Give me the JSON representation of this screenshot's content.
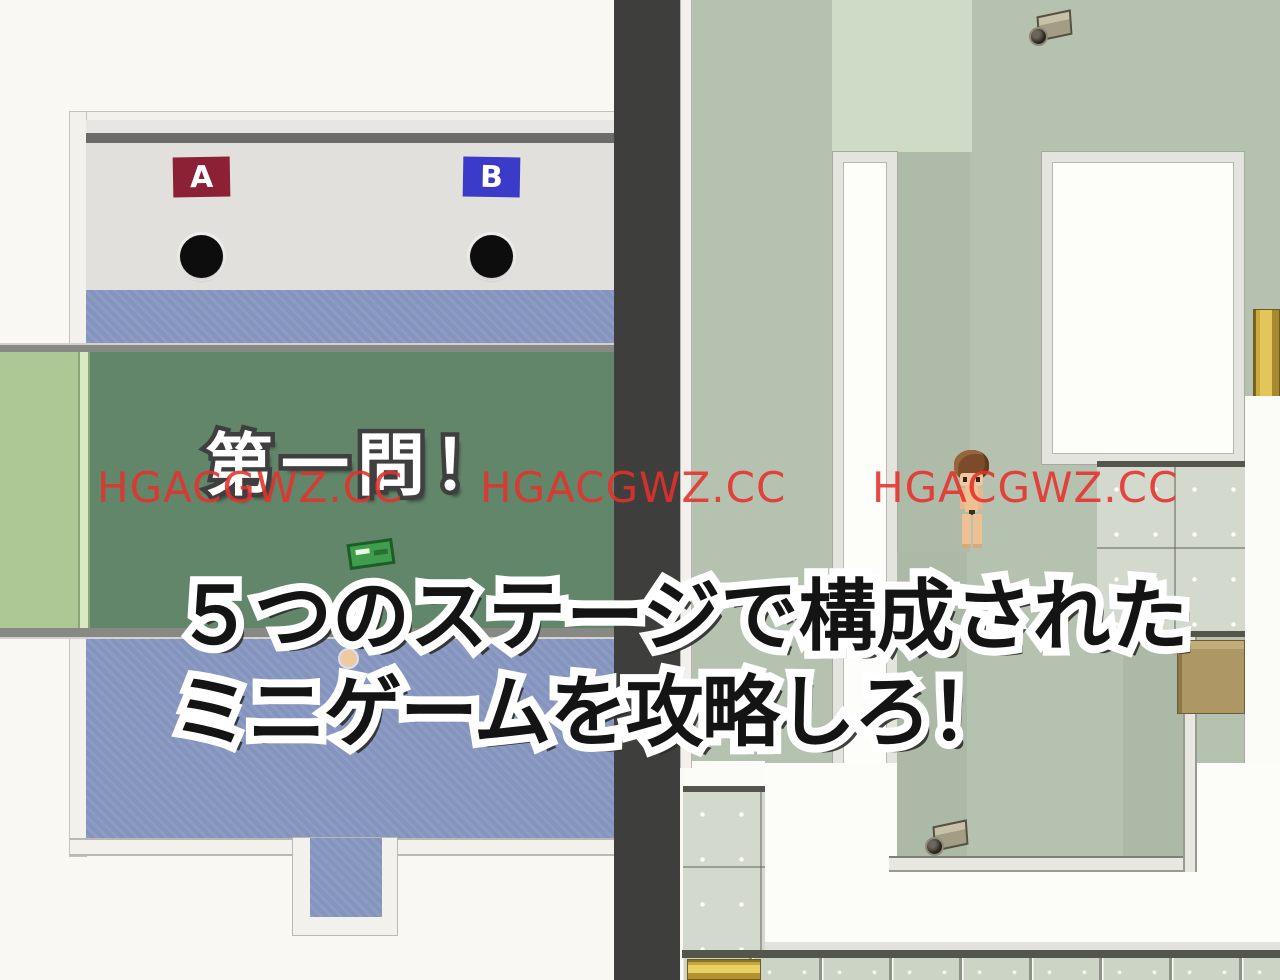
{
  "left_scene": {
    "answer_signs": {
      "a": "A",
      "b": "B"
    },
    "banner": "第一問！"
  },
  "caption": {
    "line1": "５つのステージで構成された",
    "line2": "ミニゲームを攻略しろ！"
  },
  "watermark": {
    "text": "HGACGWZ.CC",
    "count": 3,
    "color": "#e7302b"
  },
  "colors": {
    "sign_a_bg": "#8c2135",
    "sign_b_bg": "#3a3bc8",
    "table_green_dark": "#62866a",
    "table_green_light": "#adc795",
    "floor_blue": "#8494be",
    "map_sage": "#b6c2b0",
    "map_pale": "#cedbc7",
    "divider": "#3e3e3c",
    "watermark_red": "#e7302b"
  }
}
